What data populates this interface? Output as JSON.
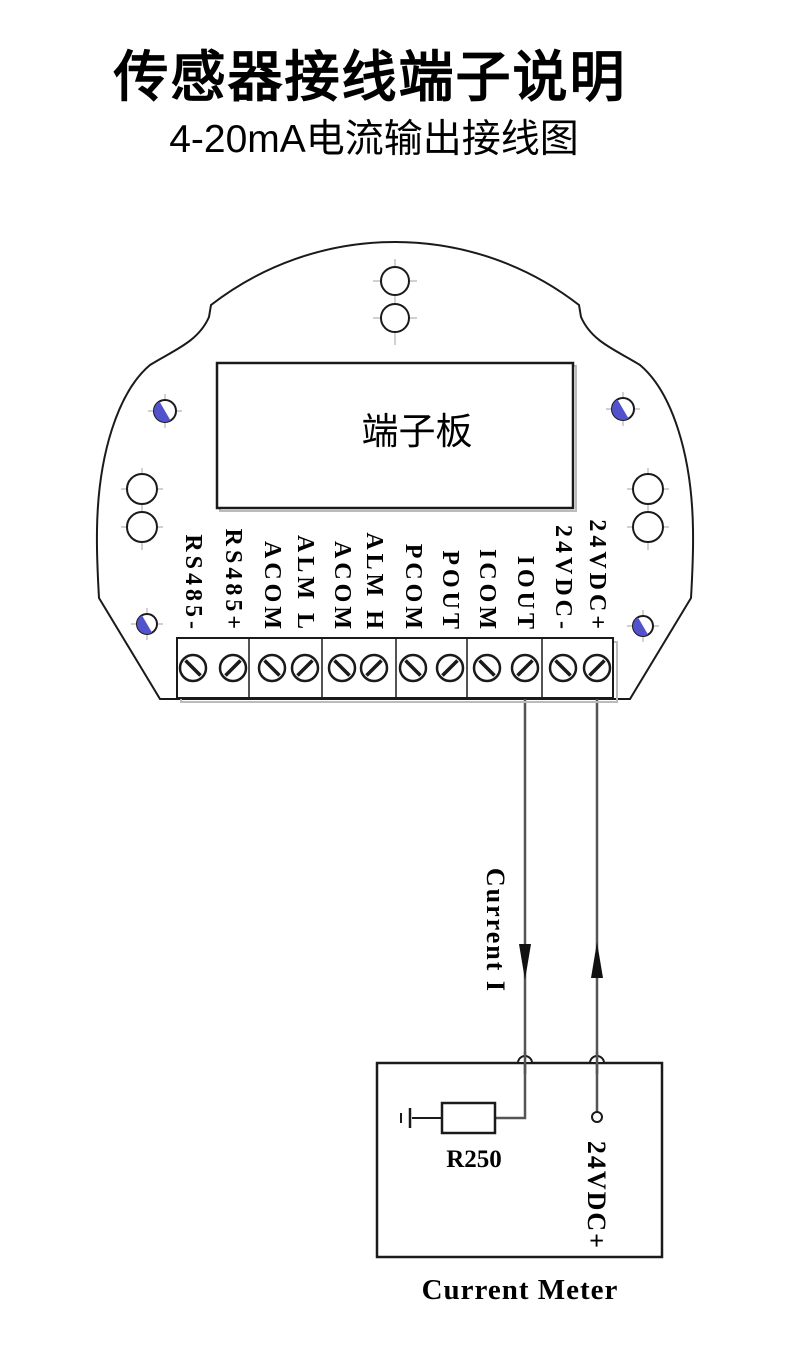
{
  "page": {
    "title": "传感器接线端子说明",
    "subtitle": "4-20mA电流输出接线图"
  },
  "device": {
    "board_label": "端子板",
    "terminal_labels": [
      "RS485-",
      "RS485+",
      "ACOM",
      "ALM L",
      "ACOM",
      "ALM H",
      "PCOM",
      "POUT",
      "ICOM",
      "IOUT",
      "24VDC-",
      "24VDC+"
    ]
  },
  "wiring": {
    "current_label": "Current I"
  },
  "meter": {
    "resistor_label": "R250",
    "supply_label": "24VDC+",
    "caption": "Current Meter"
  },
  "colors": {
    "line": "#1a1a1a",
    "wire": "#555555",
    "accent_blue": "#5252cc",
    "background": "#ffffff"
  }
}
